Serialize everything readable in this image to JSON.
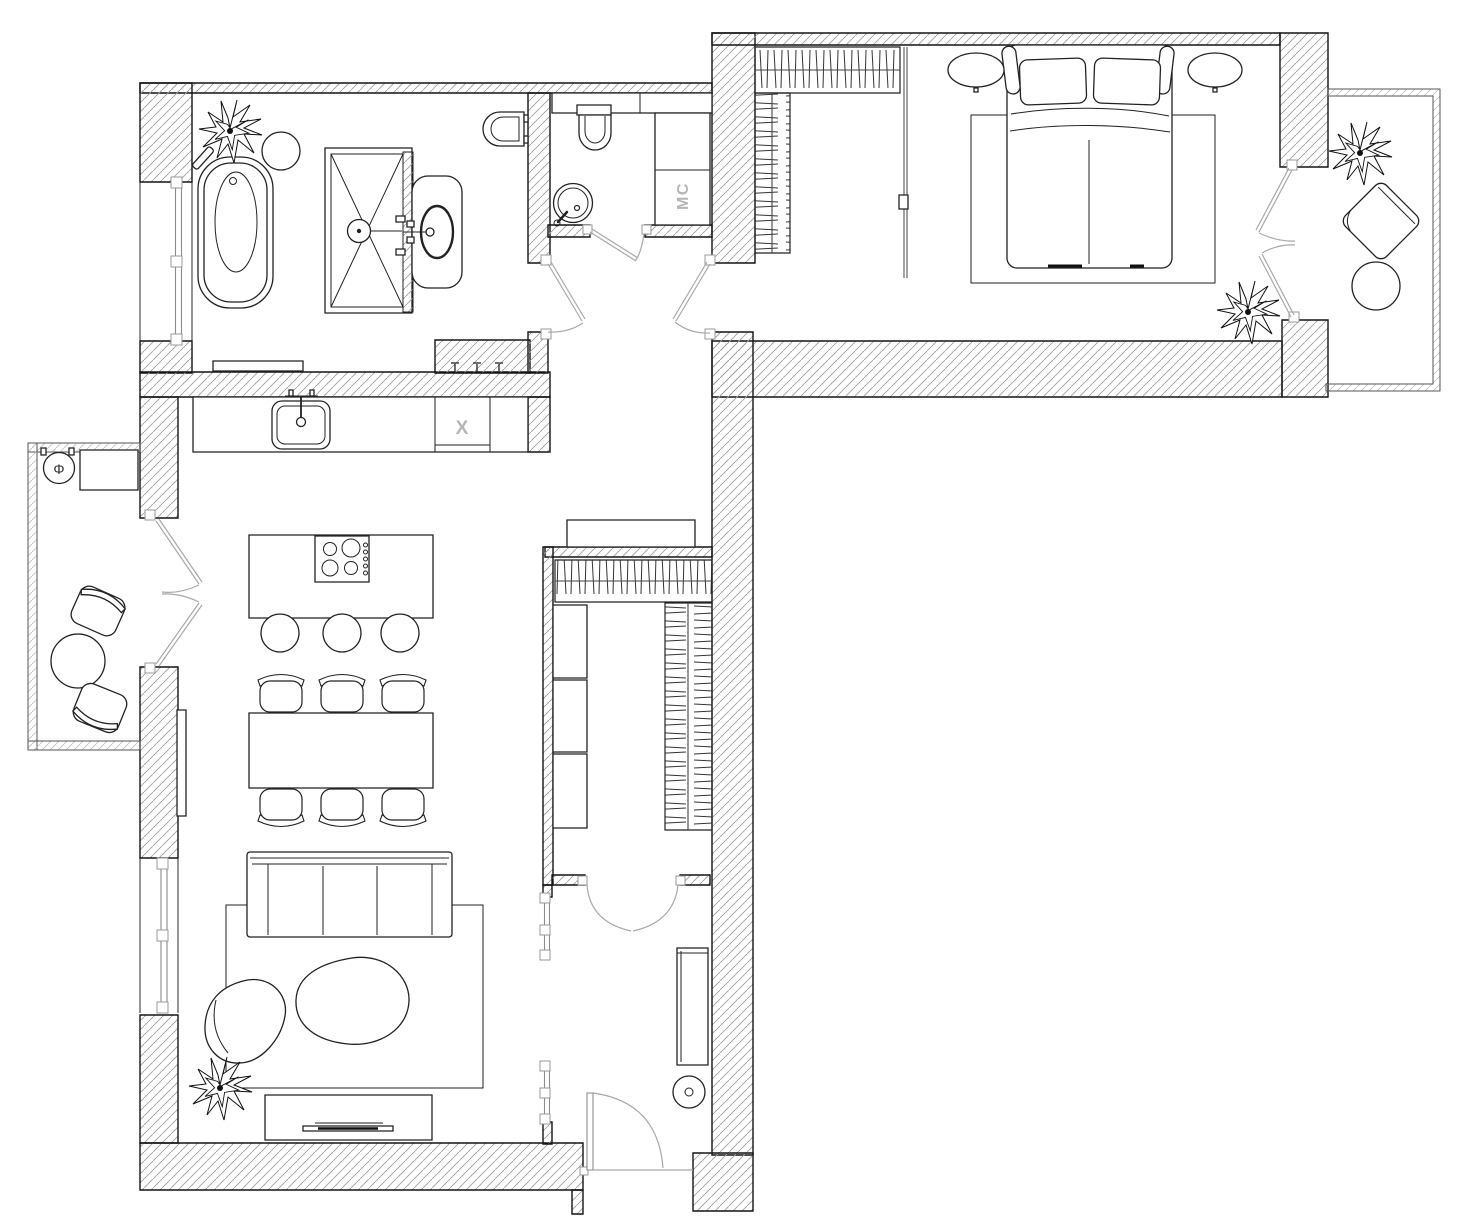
{
  "annotations": {
    "washing_machine": "MC",
    "kitchen_appliance": "X",
    "balcony_fixture": "Φ"
  },
  "colors": {
    "background": "#ffffff",
    "wall_line": "#141414",
    "wall_hatch": "#a0a0a0",
    "door_swing": "#a9a9a9",
    "label_gray": "#b5b5b5"
  },
  "rooms": [
    {
      "name": "bathroom",
      "furniture": [
        "bathtub",
        "shower-cabin",
        "vanity-sink",
        "toilet",
        "stool",
        "plant",
        "bench"
      ]
    },
    {
      "name": "wc",
      "furniture": [
        "wall-hung-toilet",
        "round-sink",
        "washer-column",
        "shelf"
      ]
    },
    {
      "name": "bedroom",
      "furniture": [
        "double-bed",
        "pillows",
        "nightstand-left",
        "nightstand-right",
        "rug",
        "wardrobe-hanging",
        "wardrobe-shelves",
        "plant"
      ]
    },
    {
      "name": "kitchen-living-room",
      "furniture": [
        "kitchen-counter",
        "kitchen-sink",
        "dishwasher",
        "island-cooktop",
        "bar-stools",
        "dining-table",
        "dining-chairs",
        "sofa",
        "armchair",
        "lounge-chair",
        "rug",
        "tv-stand",
        "tv",
        "radiator",
        "plant"
      ]
    },
    {
      "name": "walk-in-closet",
      "furniture": [
        "hanging-rail-top",
        "hanging-rail-right",
        "shelf-column",
        "cabinet"
      ]
    },
    {
      "name": "entry-hall",
      "furniture": [
        "console",
        "round-mirror",
        "glass-partition"
      ]
    },
    {
      "name": "balcony-left",
      "furniture": [
        "bistro-table",
        "chair",
        "chair",
        "bench",
        "floor-drain"
      ]
    },
    {
      "name": "balcony-right",
      "furniture": [
        "lounge-chair",
        "round-table",
        "plant"
      ]
    }
  ]
}
